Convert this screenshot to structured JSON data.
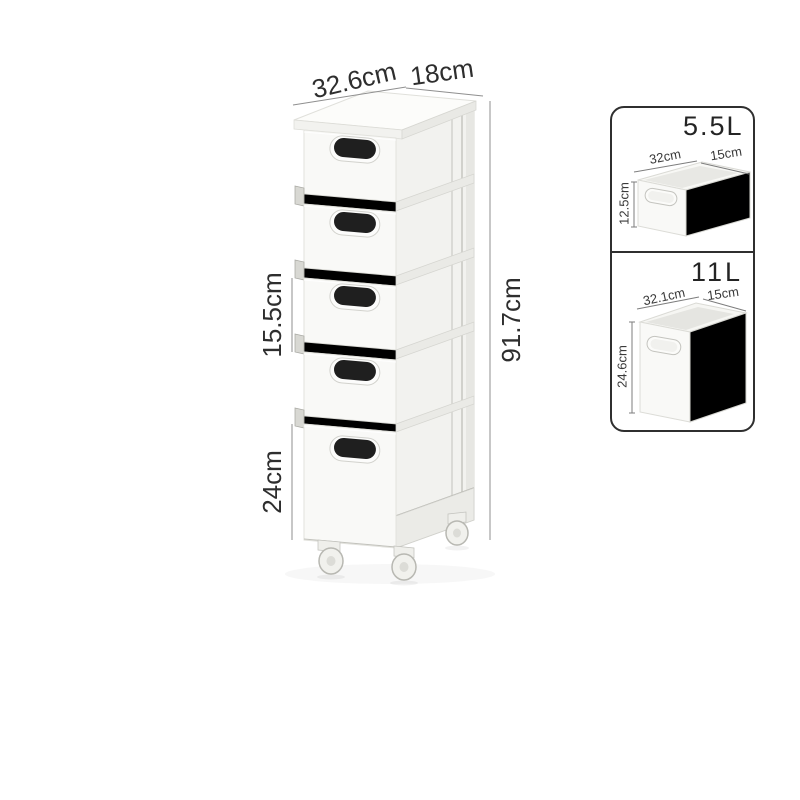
{
  "image": {
    "type": "product-dimension-diagram",
    "background": "#ffffff"
  },
  "main_unit": {
    "description": "5-tier slim rolling drawer storage cart with lid and casters",
    "dims": {
      "width": "32.6cm",
      "depth": "18cm",
      "drawer_height": "15.5cm",
      "total_height": "91.7cm",
      "bottom_drawer_height": "24cm"
    }
  },
  "size_panel": {
    "variants": [
      {
        "volume": "5.5L",
        "width": "32cm",
        "depth": "15cm",
        "height": "12.5cm"
      },
      {
        "volume": "11L",
        "width": "32.1cm",
        "depth": "15cm",
        "height": "24.6cm"
      }
    ]
  },
  "colors": {
    "background": "#ffffff",
    "dimension_line": "#8f8f8f",
    "dimension_text": "#2e2e2e",
    "panel_border": "#2f2f2f",
    "product_white": "#f9f9f7",
    "product_side": "#f2f2ef",
    "handle_black": "#1f1f1f"
  }
}
